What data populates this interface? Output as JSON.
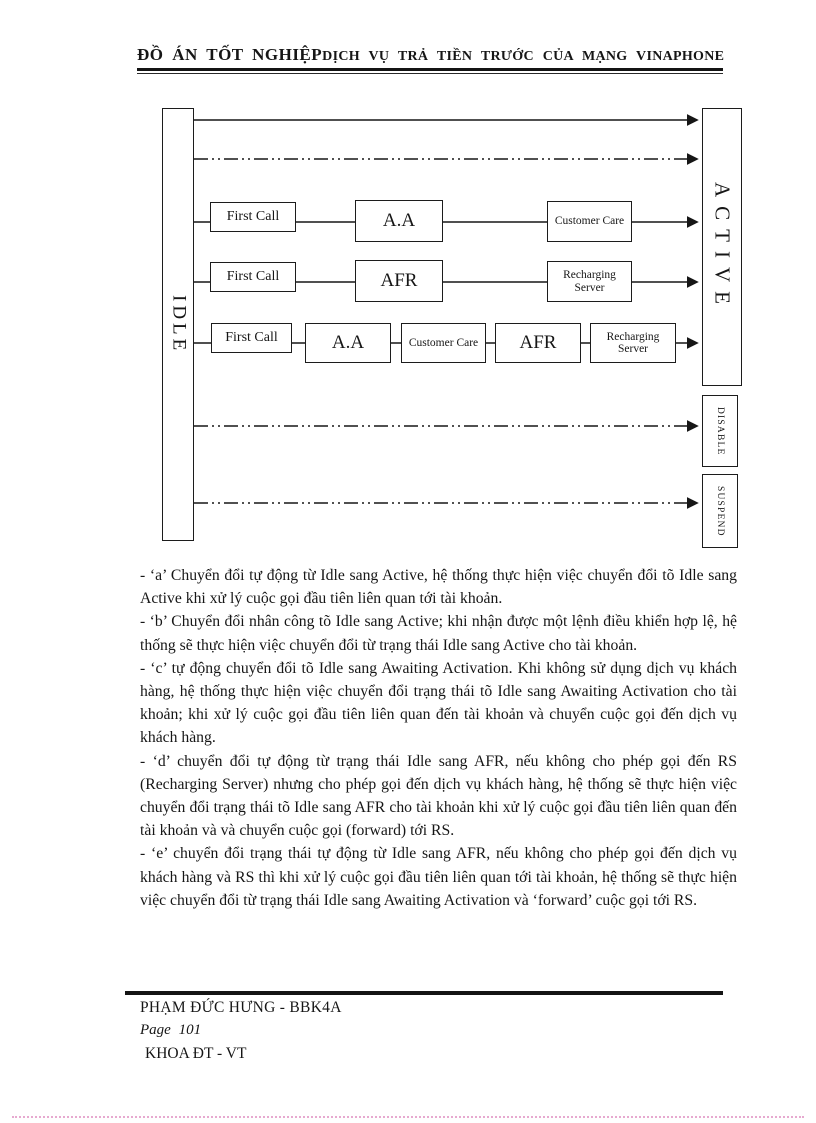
{
  "header": {
    "left_title": "ĐỒ ÁN TỐT NGHIỆP",
    "right_title": "DỊCH VỤ TRẢ TIỀN TRƯỚC CỦA MẠNG VINAPHONE"
  },
  "diagram": {
    "idle_label": "IDLE",
    "active_label": "ACTIVE",
    "disable_label": "DISABLE",
    "suspend_label": "SUSPEND",
    "row1": [
      "First Call",
      "A.A",
      "Customer Care"
    ],
    "row2": [
      "First Call",
      "AFR",
      "Recharging Server"
    ],
    "row3": [
      "First Call",
      "A.A",
      "Customer Care",
      "AFR",
      "Recharging Server"
    ]
  },
  "paragraphs": [
    "- ‘a’ Chuyển đổi tự động từ Idle sang Active, hệ thống thực hiện việc chuyển đổi tõ Idle sang Active khi xử lý cuộc gọi đầu tiên liên quan tới tài khoản.",
    "- ‘b’ Chuyển đổi nhân công tõ Idle sang Active; khi nhận được một lệnh điều khiển hợp lệ, hệ thống sẽ thực hiện việc chuyển đổi từ trạng thái Idle sang Active cho tài khoản.",
    "- ‘c’ tự động chuyển đổi tõ Idle sang Awaiting Activation. Khi không sử dụng dịch vụ khách hàng, hệ thống thực hiện việc chuyển đổi trạng thái tõ Idle sang Awaiting Activation cho tài khoản; khi xử lý cuộc gọi đầu tiên liên quan đến tài khoản và chuyển cuộc gọi đến dịch vụ khách hàng.",
    "- ‘d’ chuyển đổi tự động từ trạng thái Idle sang AFR, nếu không cho phép gọi đến RS (Recharging Server) nhưng cho phép gọi đến dịch vụ khách hàng, hệ thống sẽ thực hiện việc chuyển đổi trạng thái tõ Idle sang AFR cho tài khoản khi xử lý cuộc gọi đầu tiên liên quan đến tài khoản và và chuyển cuộc gọi (forward) tới RS.",
    "- ‘e’ chuyển đổi trạng thái tự động từ Idle sang AFR, nếu không cho phép gọi đến dịch vụ khách hàng và RS thì khi xử lý cuộc gọi đầu tiên liên quan tới tài khoản, hệ thống sẽ thực hiện việc chuyển đổi từ trạng thái Idle sang Awaiting Activation và ‘forward’ cuộc gọi tới RS."
  ],
  "footer": {
    "author": "PHẠM ĐỨC HƯNG - BBK4A",
    "page_label": "Page 101",
    "department": "KHOA ĐT - VT"
  }
}
